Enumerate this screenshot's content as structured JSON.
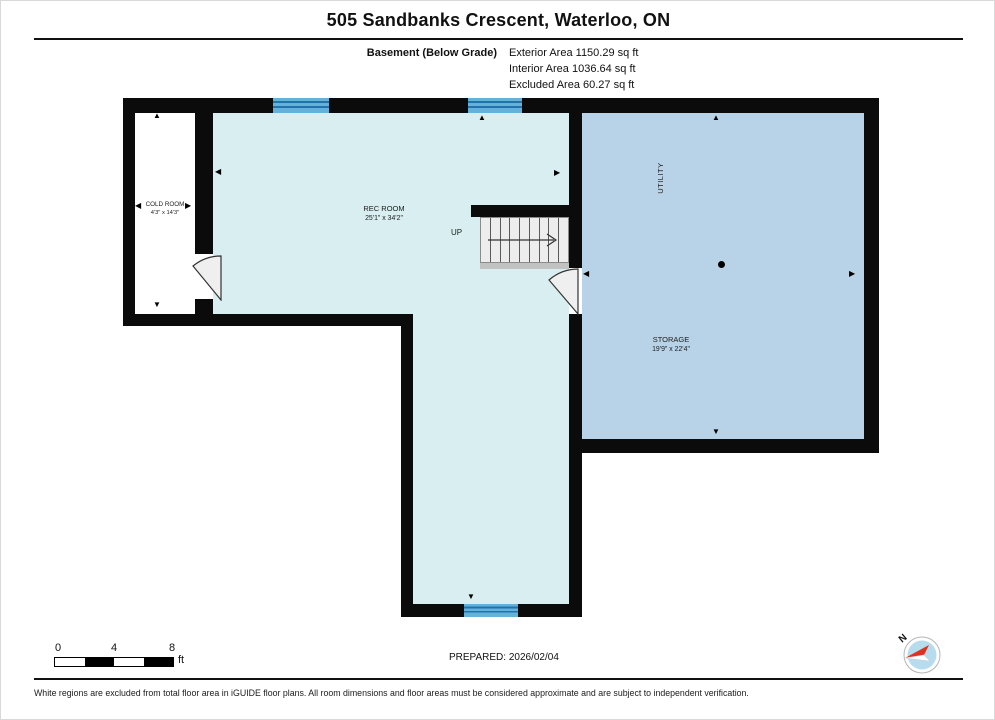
{
  "page": {
    "title": "505 Sandbanks Crescent, Waterloo, ON"
  },
  "floor_summary": {
    "floor_label": "Basement (Below Grade)",
    "exterior_area": "Exterior Area 1150.29 sq ft",
    "interior_area": "Interior Area 1036.64 sq ft",
    "excluded_area": "Excluded Area 60.27 sq ft"
  },
  "floor_plan": {
    "rooms": {
      "cold_room": {
        "name": "COLD ROOM",
        "dimensions": "4'3\" x 14'3\""
      },
      "rec_room": {
        "name": "REC ROOM",
        "dimensions": "25'1\" x 34'2\""
      },
      "storage": {
        "name": "STORAGE",
        "dimensions": "19'9\" x 22'4\""
      },
      "utility": {
        "name": "UTILITY"
      }
    },
    "stairs": {
      "label": "UP"
    }
  },
  "icons": {
    "arrow_up": "▲",
    "arrow_down": "▼",
    "arrow_left": "◀",
    "arrow_right": "▶"
  },
  "scale": {
    "ticks": [
      "0",
      "4",
      "8"
    ],
    "unit": "ft"
  },
  "prepared": {
    "label": "PREPARED: 2026/02/04"
  },
  "compass": {
    "north_label": "N"
  },
  "footer": {
    "disclaimer": "White regions are excluded from total floor area in iGUIDE floor plans. All room dimensions and floor areas must be considered approximate and are subject to independent verification."
  },
  "colors": {
    "wall": "#0b0b0b",
    "rec_room_fill": "#d9eef0",
    "storage_fill": "#b8d3e8",
    "excluded_fill": "#ffffff",
    "window": "#64b1da",
    "window_stripe": "#2272ae",
    "compass_red": "#e03020",
    "compass_fill": "#b6dcee"
  }
}
